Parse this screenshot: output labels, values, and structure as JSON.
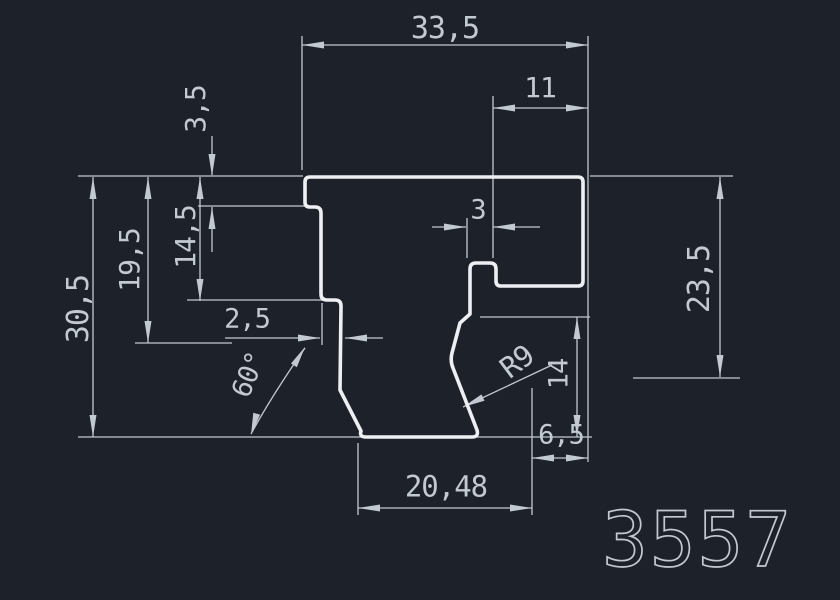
{
  "drawing": {
    "part_number": "3557",
    "colors": {
      "background": "#1d212a",
      "profile_line": "#edeff2",
      "dimension_line": "#c3c9d1",
      "text": "#c2c9d1"
    },
    "labels": {
      "top_width": "33,5",
      "top_slot": "11",
      "step_height": "3,5",
      "left_height_1": "14,5",
      "left_height_2": "19,5",
      "total_height": "30,5",
      "right_height": "23,5",
      "hook_width": "3",
      "lip_width": "2,5",
      "angle": "60°",
      "radius": "R9",
      "right_inner_height": "14",
      "bottom_right_width": "6,5",
      "bottom_width": "20,48"
    }
  }
}
